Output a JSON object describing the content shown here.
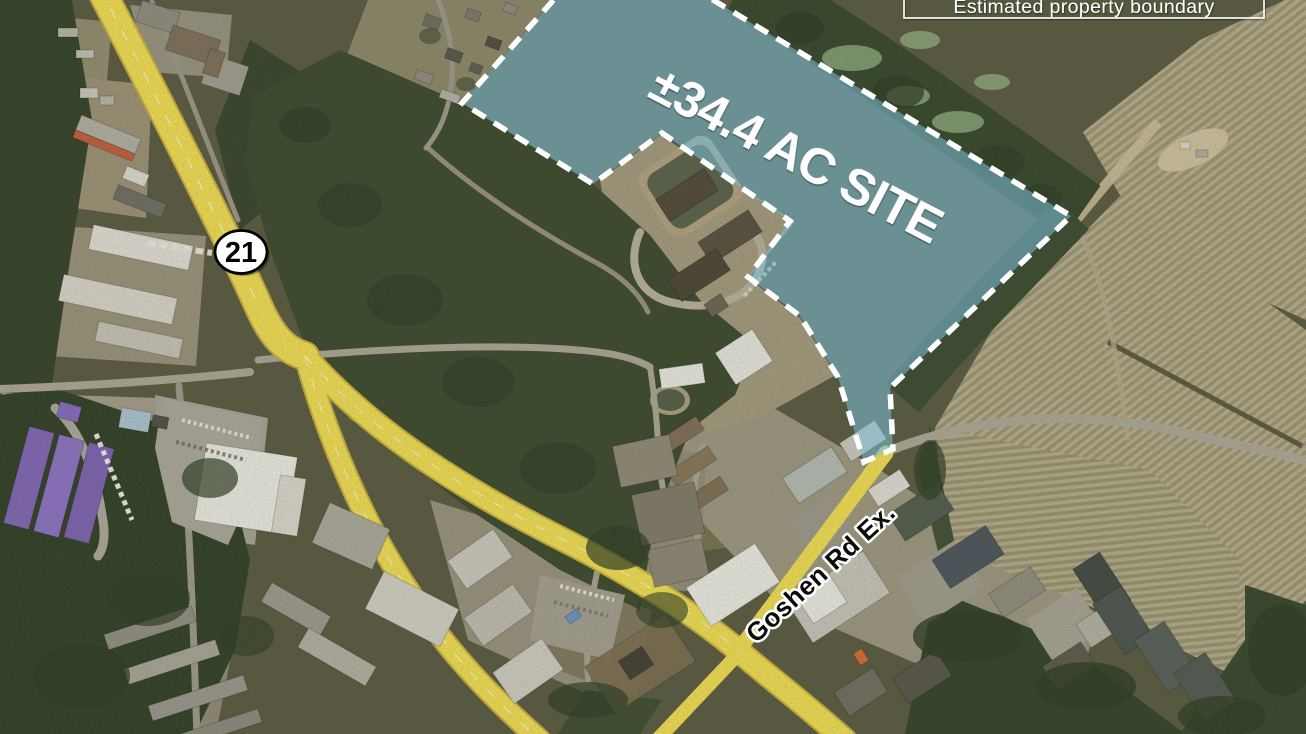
{
  "map": {
    "site": {
      "area_label": "±34.4 AC SITE"
    },
    "roads": {
      "goshen_label": "Goshen Rd Ex.",
      "route_shield": "21"
    },
    "legend": {
      "boundary_label": "Estimated property boundary"
    },
    "colors": {
      "site_fill": "#7cc0d8",
      "boundary_dash": "#ffffff",
      "highway_yellow": "#eeda52",
      "legend_border": "#ffffff",
      "label_text": "#ffffff",
      "road_label_fill": "#0b0b0b",
      "road_label_outline": "#ffffff"
    }
  }
}
